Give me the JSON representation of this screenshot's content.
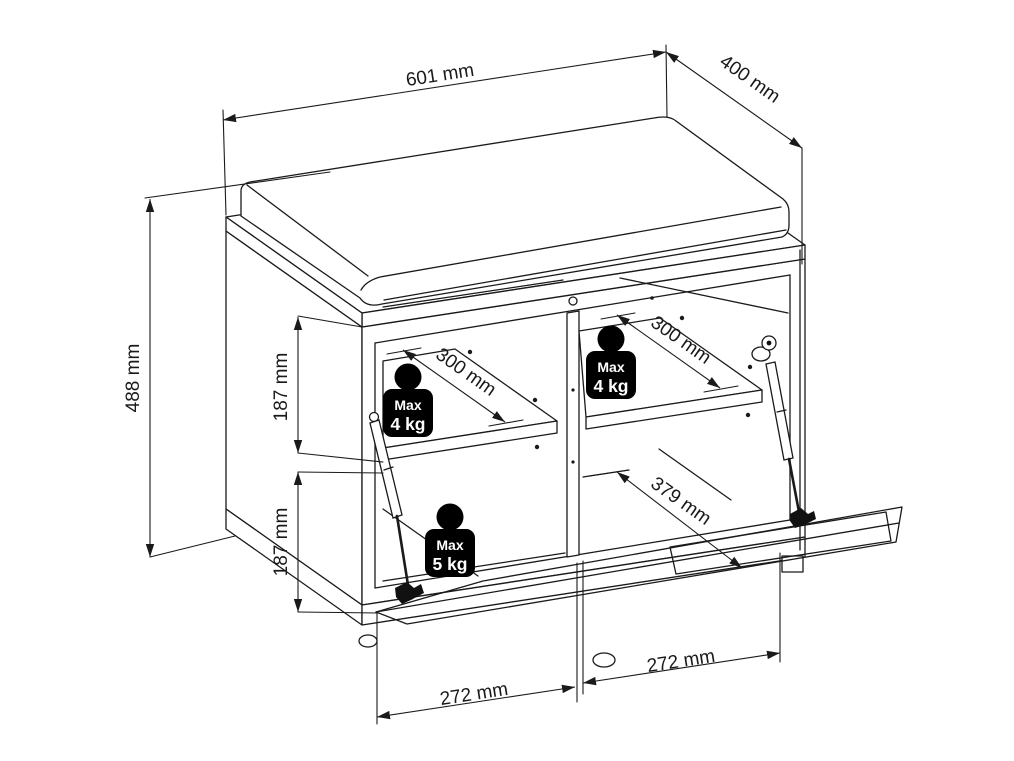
{
  "drawing": {
    "kind": "furniture dimension diagram (shoe bench with seat cushion, open flap door)",
    "dimensions": {
      "top_width": "601 mm",
      "top_depth": "400 mm",
      "overall_height": "488 mm",
      "upper_compartment_height": "187 mm",
      "lower_compartment_height": "187 mm",
      "left_shelf_depth": "300 mm",
      "right_shelf_depth": "300 mm",
      "open_door_depth": "379 mm",
      "bottom_left_width": "272 mm",
      "bottom_right_width": "272 mm"
    },
    "load_limits": {
      "upper_left": {
        "label": "Max",
        "value": "4 kg"
      },
      "upper_right": {
        "label": "Max",
        "value": "4 kg"
      },
      "lower": {
        "label": "Max",
        "value": "5 kg"
      }
    },
    "colors": {
      "line": "#1a1a1a",
      "background": "#ffffff",
      "badge_bg": "#000000",
      "badge_text": "#ffffff"
    }
  }
}
